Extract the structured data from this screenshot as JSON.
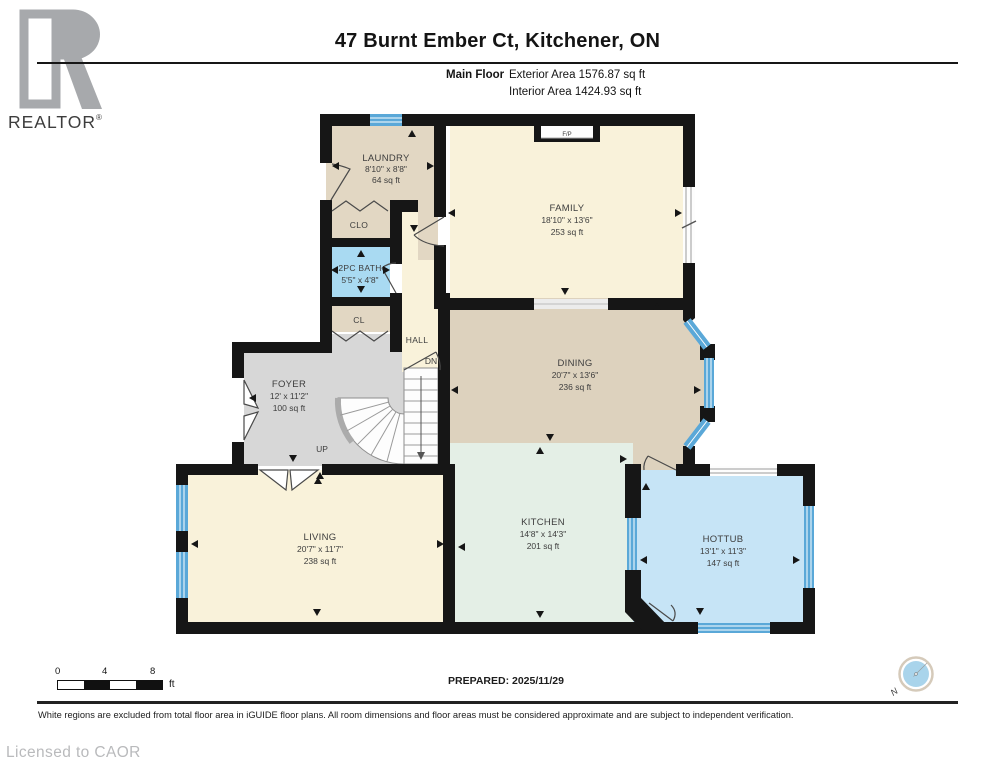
{
  "header": {
    "title": "47 Burnt Ember Ct, Kitchener, ON",
    "floor_label": "Main Floor",
    "exterior_area": "Exterior Area 1576.87 sq ft",
    "interior_area": "Interior Area 1424.93 sq ft"
  },
  "logo": {
    "text": "REALTOR",
    "registered": "®"
  },
  "rooms": {
    "laundry": {
      "name": "LAUNDRY",
      "dims": "8'10\" x 8'8\"",
      "area": "64 sq ft"
    },
    "family": {
      "name": "FAMILY",
      "dims": "18'10\" x 13'6\"",
      "area": "253 sq ft"
    },
    "dining": {
      "name": "DINING",
      "dims": "20'7\" x 13'6\"",
      "area": "236 sq ft"
    },
    "kitchen": {
      "name": "KITCHEN",
      "dims": "14'8\" x 14'3\"",
      "area": "201 sq ft"
    },
    "living": {
      "name": "LIVING",
      "dims": "20'7\" x 11'7\"",
      "area": "238 sq ft"
    },
    "foyer": {
      "name": "FOYER",
      "dims": "12' x 11'2\"",
      "area": "100 sq ft"
    },
    "hottub": {
      "name": "HOTTUB",
      "dims": "13'1\" x 11'3\"",
      "area": "147 sq ft"
    },
    "bath": {
      "name": "2PC BATH",
      "dims": "5'5\" x 4'8\""
    },
    "clo": {
      "name": "CLO"
    },
    "cl": {
      "name": "CL"
    },
    "hall": {
      "name": "HALL"
    }
  },
  "plan_labels": {
    "up": "UP",
    "dn": "DN",
    "fireplace": "F/P"
  },
  "scale_bar": {
    "tick0": "0",
    "tick1": "4",
    "tick2": "8",
    "unit": "ft"
  },
  "compass": {
    "north": "N"
  },
  "footer": {
    "prepared": "PREPARED: 2025/11/29",
    "disclaimer": "White regions are excluded from total floor area in iGUIDE floor plans. All room dimensions and floor areas must be considered approximate and are subject to independent verification.",
    "licensed": "Licensed to CAOR"
  },
  "colors": {
    "wall": "#161616",
    "window": "#5aa8d8",
    "room_cream": "#f9f2da",
    "room_tan": "#e2d7c3",
    "room_tan_dark": "#ddd2be",
    "room_blue": "#a9daf2",
    "room_hottub": "#c6e4f6",
    "room_mint": "#e4efe6",
    "room_gray": "#d7d7d7"
  }
}
